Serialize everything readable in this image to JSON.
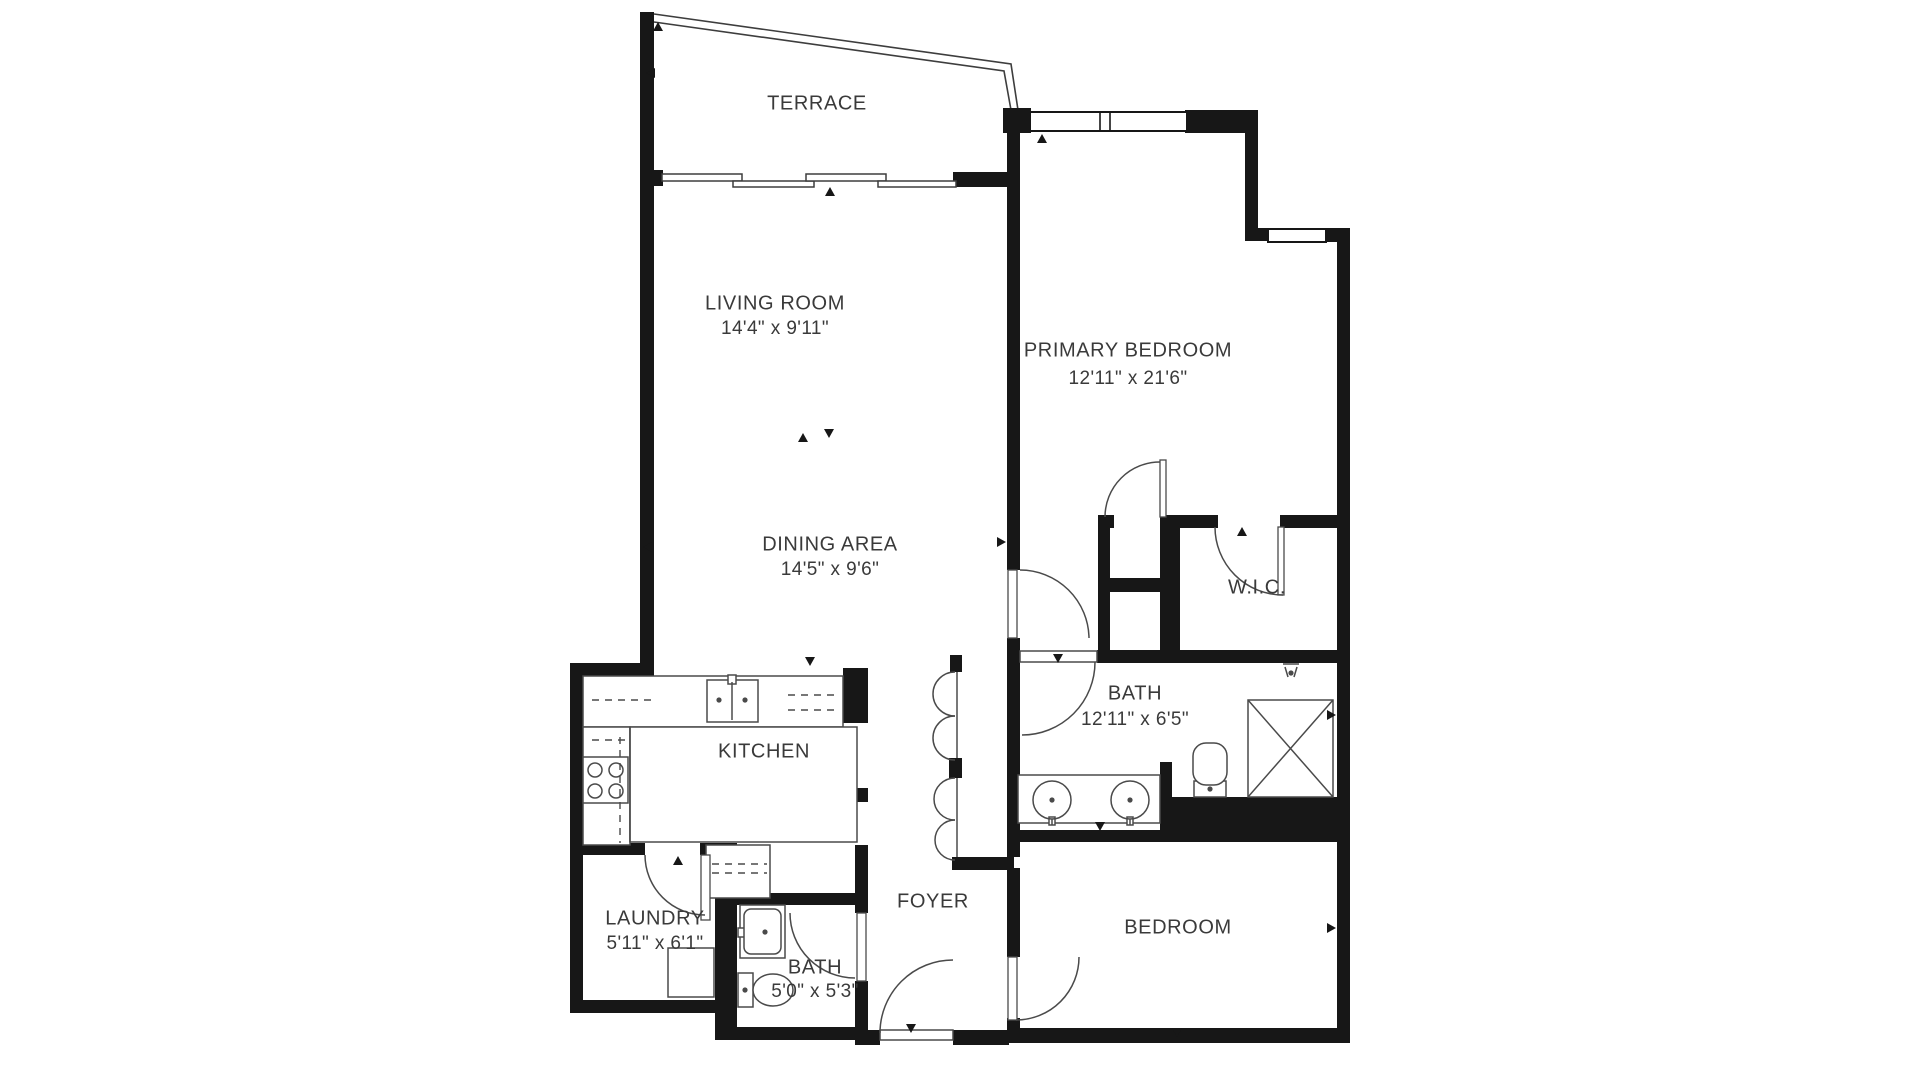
{
  "title": "Apartment Floor Plan",
  "colors": {
    "wall": "#171717",
    "line": "#3d3d3d",
    "fixture": "#4a4a4a",
    "label": "#3a3a3a",
    "bg": "#ffffff"
  },
  "canvas": {
    "width": 1920,
    "height": 1080
  },
  "rooms": [
    {
      "id": "terrace",
      "name": "TERRACE",
      "dims": "",
      "x": 817,
      "y": 104
    },
    {
      "id": "living-room",
      "name": "LIVING ROOM",
      "dims": "14'4\" x 9'11\"",
      "x": 775,
      "y": 304,
      "dy": 329
    },
    {
      "id": "primary-bedroom",
      "name": "PRIMARY BEDROOM",
      "dims": "12'11\" x 21'6\"",
      "x": 1128,
      "y": 351,
      "dy": 379
    },
    {
      "id": "dining-area",
      "name": "DINING AREA",
      "dims": "14'5\" x 9'6\"",
      "x": 830,
      "y": 545,
      "dy": 570
    },
    {
      "id": "wic",
      "name": "W.I.C.",
      "dims": "",
      "x": 1257,
      "y": 588
    },
    {
      "id": "bath-main",
      "name": "BATH",
      "dims": "12'11\" x 6'5\"",
      "x": 1135,
      "y": 694,
      "dy": 720
    },
    {
      "id": "kitchen",
      "name": "KITCHEN",
      "dims": "",
      "x": 764,
      "y": 752
    },
    {
      "id": "foyer",
      "name": "FOYER",
      "dims": "",
      "x": 933,
      "y": 902
    },
    {
      "id": "laundry",
      "name": "LAUNDRY",
      "dims": "5'11\" x 6'1\"",
      "x": 655,
      "y": 919,
      "dy": 944
    },
    {
      "id": "bath-small",
      "name": "BATH",
      "dims": "5'0\" x 5'3\"",
      "x": 815,
      "y": 968,
      "dy": 992
    },
    {
      "id": "bedroom",
      "name": "BEDROOM",
      "dims": "",
      "x": 1178,
      "y": 928
    }
  ],
  "walls": [
    [
      640,
      12,
      14,
      664
    ],
    [
      570,
      663,
      84,
      13
    ],
    [
      570,
      663,
      13,
      350
    ],
    [
      570,
      1000,
      158,
      13
    ],
    [
      715,
      1000,
      13,
      40
    ],
    [
      715,
      1027,
      153,
      13
    ],
    [
      855,
      1030,
      25,
      15
    ],
    [
      953,
      1030,
      56,
      15
    ],
    [
      1007,
      1028,
      343,
      15
    ],
    [
      1337,
      240,
      13,
      803
    ],
    [
      1245,
      228,
      26,
      13
    ],
    [
      1324,
      228,
      26,
      14
    ],
    [
      1245,
      123,
      13,
      110
    ],
    [
      1185,
      110,
      73,
      23
    ],
    [
      1003,
      108,
      28,
      25
    ],
    [
      1007,
      112,
      13,
      458
    ],
    [
      1007,
      638,
      13,
      219
    ],
    [
      952,
      857,
      62,
      13
    ],
    [
      1007,
      868,
      13,
      89
    ],
    [
      1007,
      1018,
      13,
      12
    ],
    [
      953,
      172,
      54,
      15
    ],
    [
      653,
      170,
      10,
      16
    ],
    [
      1098,
      515,
      16,
      13
    ],
    [
      1160,
      515,
      58,
      13
    ],
    [
      1280,
      515,
      67,
      13
    ],
    [
      1098,
      515,
      12,
      140
    ],
    [
      1160,
      515,
      20,
      148
    ],
    [
      1098,
      578,
      75,
      14
    ],
    [
      1097,
      650,
      250,
      13
    ],
    [
      1160,
      762,
      12,
      68
    ],
    [
      1160,
      797,
      187,
      33
    ],
    [
      1018,
      830,
      332,
      12
    ],
    [
      950,
      655,
      12,
      17
    ],
    [
      949,
      758,
      13,
      20
    ],
    [
      843,
      668,
      25,
      55
    ],
    [
      855,
      788,
      13,
      14
    ],
    [
      855,
      845,
      13,
      68
    ],
    [
      855,
      981,
      13,
      51
    ],
    [
      715,
      843,
      22,
      190
    ],
    [
      570,
      843,
      75,
      12
    ],
    [
      700,
      843,
      37,
      12
    ],
    [
      727,
      893,
      128,
      12
    ]
  ],
  "windows": [
    {
      "rect": [
        1030,
        112,
        157,
        19
      ],
      "mullions": [
        1100,
        1110
      ]
    },
    {
      "rect": [
        1268,
        229,
        58,
        13
      ],
      "mullions": []
    }
  ],
  "slider_panels": [
    [
      662,
      174,
      80,
      7
    ],
    [
      733,
      181,
      81,
      6
    ],
    [
      806,
      174,
      80,
      7
    ],
    [
      878,
      181,
      78,
      6
    ]
  ],
  "railing_paths": [
    "M654,14 L1011,64 L1018,110",
    "M654,22 L1004,71 L1011,110"
  ],
  "door_arcs": [
    {
      "id": "door-dining-hall",
      "d": "M1020,570 A69,69 0 0 1 1089,638"
    },
    {
      "id": "door-closet-primary",
      "d": "M1105,517 A55,55 0 0 1 1160,462"
    },
    {
      "id": "door-wic",
      "d": "M1215,527 A68,68 0 0 0 1283,595"
    },
    {
      "id": "door-hall-bath",
      "d": "M1095,662 A73,73 0 0 1 1022,735"
    },
    {
      "id": "door-laundry",
      "d": "M645,855 A60,60 0 0 0 705,915"
    },
    {
      "id": "door-bath-small",
      "d": "M790,913 A65,65 0 0 0 855,978"
    },
    {
      "id": "door-entry",
      "d": "M880,1033 A73,73 0 0 1 953,960"
    },
    {
      "id": "door-bedroom",
      "d": "M1016,1020 A63,63 0 0 0 1079,957"
    }
  ],
  "bifold_paths": [
    "M955,672 A22,22 0 0 0 955,716",
    "M955,716 A22,22 0 0 0 955,760",
    "M955,778 A21,21 0 0 0 955,820",
    "M955,820 A20,20 0 0 0 955,860"
  ],
  "door_leaves": [
    [
      1008,
      570,
      9,
      68
    ],
    [
      1008,
      957,
      9,
      63
    ],
    [
      857,
      913,
      9,
      68
    ],
    [
      701,
      855,
      9,
      65
    ],
    [
      1160,
      460,
      6,
      57
    ],
    [
      1278,
      527,
      6,
      68
    ]
  ],
  "fixture_rects": [
    {
      "id": "kitchen-counter-top",
      "rect": [
        583,
        676,
        260,
        51
      ]
    },
    {
      "id": "kitchen-sink",
      "rect": [
        707,
        680,
        51,
        42
      ]
    },
    {
      "id": "kitchen-faucet",
      "rect": [
        728,
        675,
        8,
        9
      ]
    },
    {
      "id": "kitchen-counter-left",
      "rect": [
        583,
        727,
        47,
        118
      ]
    },
    {
      "id": "stove",
      "rect": [
        583,
        757,
        45,
        46
      ]
    },
    {
      "id": "kitchen-island",
      "rect": [
        630,
        727,
        227,
        115
      ]
    },
    {
      "id": "kitchen-peninsula",
      "rect": [
        706,
        845,
        64,
        53
      ]
    },
    {
      "id": "washer",
      "rect": [
        668,
        948,
        46,
        49
      ]
    },
    {
      "id": "small-bath-sink",
      "rect": [
        740,
        905,
        45,
        53
      ]
    },
    {
      "id": "small-bath-faucet",
      "rect": [
        738,
        928,
        8,
        9
      ]
    },
    {
      "id": "small-bath-toilet-tank",
      "rect": [
        738,
        973,
        15,
        34
      ]
    },
    {
      "id": "vanity-counter",
      "rect": [
        1018,
        775,
        142,
        48
      ]
    },
    {
      "id": "vanity-faucet-1",
      "rect": [
        1049,
        817,
        6,
        8
      ]
    },
    {
      "id": "vanity-faucet-2",
      "rect": [
        1127,
        817,
        6,
        8
      ]
    },
    {
      "id": "toilet-tank",
      "rect": [
        1194,
        781,
        32,
        16
      ]
    },
    {
      "id": "shower",
      "rect": [
        1248,
        700,
        85,
        97
      ]
    },
    {
      "id": "entry-threshold",
      "rect": [
        880,
        1030,
        73,
        10
      ]
    },
    {
      "id": "hall-bath-threshold",
      "rect": [
        1020,
        651,
        77,
        11
      ]
    }
  ],
  "rounded_rects": [
    {
      "id": "small-bath-sink-basin",
      "rect": [
        744,
        909,
        37,
        45
      ],
      "r": 7
    },
    {
      "id": "toilet-bowl",
      "rect": [
        1193,
        743,
        34,
        42
      ],
      "r": 13
    }
  ],
  "circles": [
    {
      "id": "vanity-sink-1",
      "cx": 1052,
      "cy": 800,
      "r": 19
    },
    {
      "id": "vanity-sink-2",
      "cx": 1130,
      "cy": 800,
      "r": 19
    },
    {
      "id": "burner-1",
      "cx": 595,
      "cy": 770,
      "r": 7
    },
    {
      "id": "burner-2",
      "cx": 616,
      "cy": 770,
      "r": 7
    },
    {
      "id": "burner-3",
      "cx": 595,
      "cy": 791,
      "r": 7
    },
    {
      "id": "burner-4",
      "cx": 616,
      "cy": 791,
      "r": 7
    }
  ],
  "dots": [
    [
      719,
      700
    ],
    [
      745,
      700
    ],
    [
      765,
      932
    ],
    [
      745,
      990
    ],
    [
      1052,
      800
    ],
    [
      1130,
      800
    ],
    [
      1210,
      789
    ],
    [
      1291,
      673
    ]
  ],
  "ellipses": [
    {
      "id": "small-bath-toilet-bowl",
      "cx": 773,
      "cy": 990,
      "rx": 20,
      "ry": 16
    }
  ],
  "solid_lines": [
    [
      732,
      682,
      732,
      720
    ],
    [
      1248,
      700,
      1333,
      797
    ],
    [
      1333,
      700,
      1248,
      797
    ],
    [
      957,
      672,
      957,
      758
    ],
    [
      957,
      778,
      957,
      857
    ],
    [
      1052,
      819,
      1052,
      825
    ],
    [
      1130,
      819,
      1130,
      825
    ],
    [
      1283,
      664,
      1299,
      664
    ],
    [
      1285,
      667,
      1288,
      677
    ],
    [
      1297,
      667,
      1294,
      677
    ],
    [
      630,
      727,
      630,
      842
    ]
  ],
  "dashed_lines": [
    [
      620,
      737,
      620,
      843
    ],
    [
      592,
      740,
      628,
      740
    ],
    [
      592,
      700,
      652,
      700
    ],
    [
      788,
      695,
      840,
      695
    ],
    [
      788,
      710,
      840,
      710
    ],
    [
      712,
      864,
      767,
      864
    ],
    [
      712,
      873,
      767,
      873
    ]
  ],
  "ticks": [
    [
      830,
      192,
      "up"
    ],
    [
      1042,
      139,
      "up"
    ],
    [
      658,
      27,
      "up"
    ],
    [
      651,
      73,
      "left"
    ],
    [
      648,
      547,
      "left"
    ],
    [
      1001,
      542,
      "right"
    ],
    [
      1331,
      715,
      "right"
    ],
    [
      1331,
      928,
      "right"
    ],
    [
      1177,
      1032,
      "down"
    ],
    [
      911,
      1028,
      "down"
    ],
    [
      1058,
      658,
      "down"
    ],
    [
      678,
      861,
      "up"
    ],
    [
      810,
      661,
      "down"
    ],
    [
      1242,
      532,
      "up"
    ],
    [
      1100,
      826,
      "down"
    ],
    [
      803,
      438,
      "up"
    ],
    [
      829,
      433,
      "down"
    ]
  ],
  "font": {
    "room_size": 20,
    "dim_size": 19
  }
}
